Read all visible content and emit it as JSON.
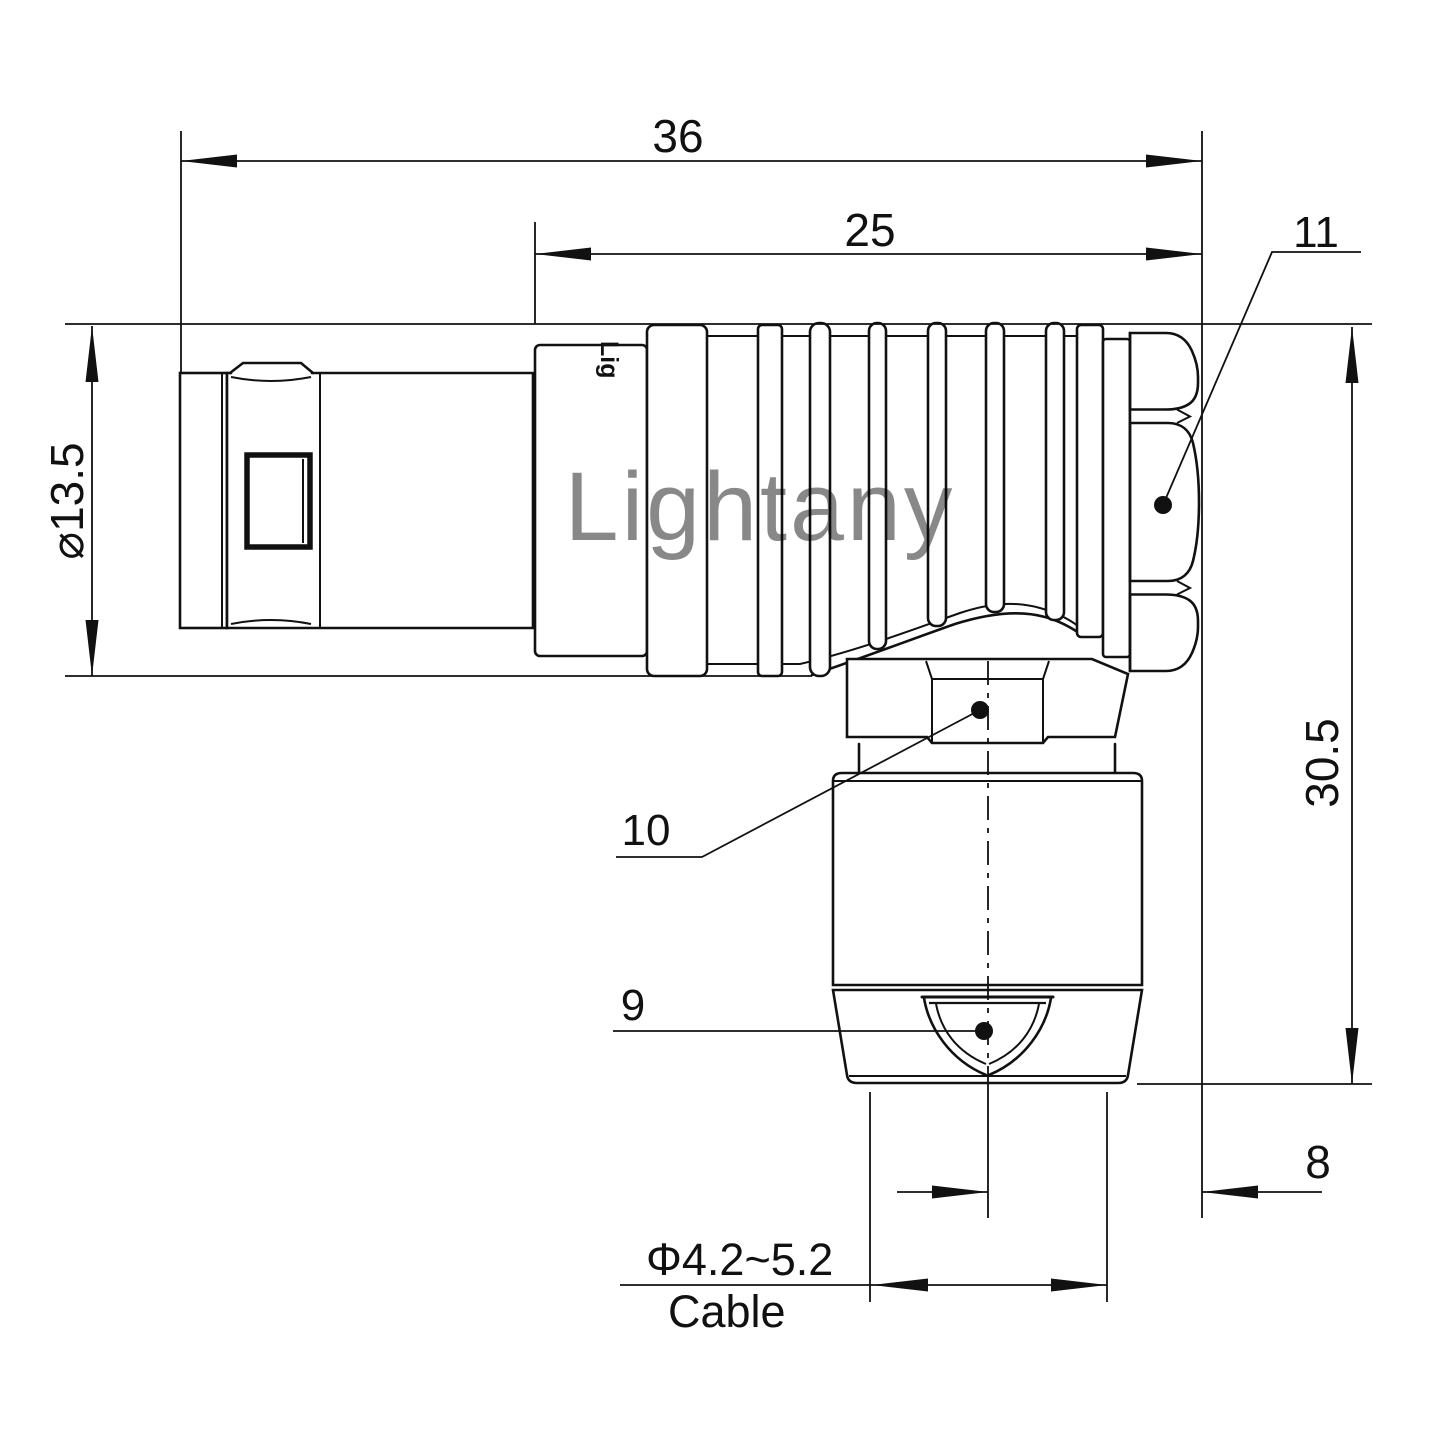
{
  "drawing": {
    "watermark": "Lightany",
    "body_logo": "Lig",
    "dims": {
      "overall_length": "36",
      "rear_length": "25",
      "front_diameter": "⌀13.5",
      "total_height": "30.5",
      "axis_offset": "8",
      "cable_diameter_range": "Φ4.2~5.2",
      "cable_word": "Cable"
    },
    "callouts": {
      "back_nut": "11",
      "coupling_nut": "10",
      "cable_gland": "9"
    }
  }
}
